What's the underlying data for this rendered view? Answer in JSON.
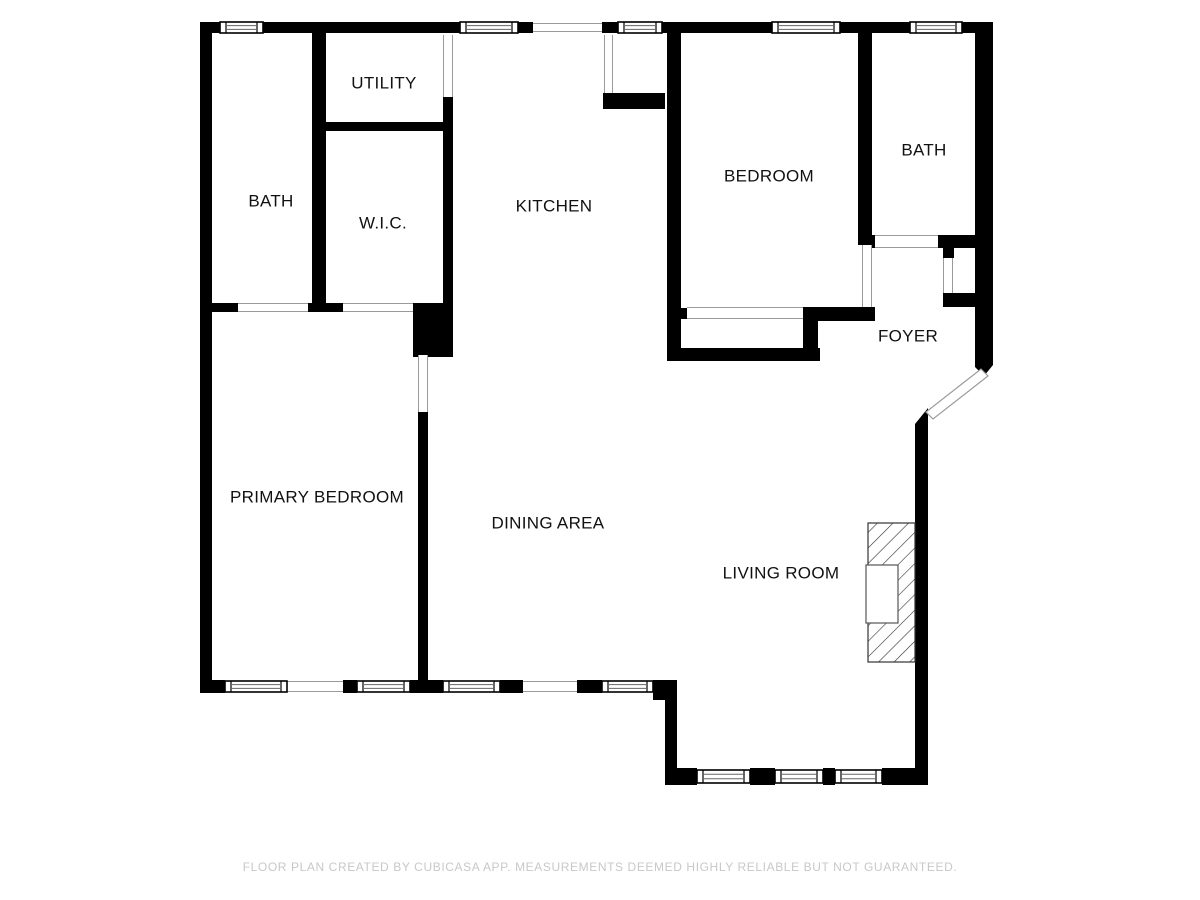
{
  "footer": {
    "text": "FLOOR PLAN CREATED BY CUBICASA APP. MEASUREMENTS DEEMED HIGHLY RELIABLE BUT NOT GUARANTEED."
  },
  "colors": {
    "background": "#ffffff",
    "wall": "#000000",
    "opening_line": "#9a9a9a",
    "window_frame": "#000000",
    "window_glass_line": "#666666",
    "label_text": "#111111",
    "caption_text": "#c8c8c8",
    "hatch": "#333333",
    "firebox_stroke": "#555555"
  },
  "rooms": [
    {
      "id": "utility",
      "label": "UTILITY",
      "x": 384,
      "y": 84
    },
    {
      "id": "bath-left",
      "label": "BATH",
      "x": 271,
      "y": 202
    },
    {
      "id": "wic",
      "label": "W.I.C.",
      "x": 383,
      "y": 224
    },
    {
      "id": "kitchen",
      "label": "KITCHEN",
      "x": 554,
      "y": 207
    },
    {
      "id": "bedroom",
      "label": "BEDROOM",
      "x": 769,
      "y": 177
    },
    {
      "id": "bath-right",
      "label": "BATH",
      "x": 924,
      "y": 151
    },
    {
      "id": "foyer",
      "label": "FOYER",
      "x": 908,
      "y": 337
    },
    {
      "id": "primary-bedroom",
      "label": "PRIMARY BEDROOM",
      "x": 317,
      "y": 498
    },
    {
      "id": "dining-area",
      "label": "DINING AREA",
      "x": 548,
      "y": 524
    },
    {
      "id": "living-room",
      "label": "LIVING ROOM",
      "x": 781,
      "y": 574
    }
  ],
  "plan": {
    "walls": [
      [
        200,
        22,
        20,
        11
      ],
      [
        263,
        22,
        197,
        11
      ],
      [
        518,
        22,
        15,
        11
      ],
      [
        602,
        22,
        16,
        11
      ],
      [
        662,
        22,
        110,
        11
      ],
      [
        840,
        22,
        70,
        11
      ],
      [
        962,
        22,
        31,
        11
      ],
      [
        200,
        33,
        12,
        660
      ],
      [
        200,
        680,
        25,
        13
      ],
      [
        343,
        680,
        14,
        13
      ],
      [
        410,
        680,
        33,
        13
      ],
      [
        500,
        680,
        23,
        13
      ],
      [
        577,
        680,
        25,
        13
      ],
      [
        653,
        680,
        24,
        20
      ],
      [
        665,
        680,
        12,
        100
      ],
      [
        665,
        768,
        32,
        17
      ],
      [
        750,
        768,
        25,
        17
      ],
      [
        823,
        768,
        12,
        17
      ],
      [
        882,
        768,
        45,
        17
      ],
      [
        915,
        424,
        13,
        361
      ],
      [
        975,
        33,
        18,
        325
      ],
      [
        312,
        33,
        14,
        270
      ],
      [
        326,
        122,
        117,
        9
      ],
      [
        443,
        97,
        10,
        206
      ],
      [
        212,
        303,
        26,
        9
      ],
      [
        308,
        303,
        35,
        9
      ],
      [
        413,
        303,
        40,
        54
      ],
      [
        418,
        412,
        10,
        268
      ],
      [
        603,
        93,
        62,
        16
      ],
      [
        667,
        33,
        14,
        328
      ],
      [
        667,
        348,
        153,
        13
      ],
      [
        803,
        310,
        15,
        43
      ],
      [
        677,
        308,
        10,
        11
      ],
      [
        803,
        307,
        72,
        14
      ],
      [
        858,
        33,
        14,
        212
      ],
      [
        866,
        235,
        9,
        13
      ],
      [
        938,
        235,
        55,
        13
      ],
      [
        943,
        246,
        11,
        12
      ],
      [
        943,
        293,
        50,
        14
      ]
    ],
    "wall_polys": [
      "915,424 928,424 928,408",
      "975,358 993,358 993,365 984,376 975,367"
    ],
    "entry_door_leaf": "981,369 988,376 933,419 926,412",
    "windows": [
      [
        220,
        22,
        43,
        11
      ],
      [
        460,
        22,
        58,
        11
      ],
      [
        618,
        22,
        44,
        11
      ],
      [
        772,
        22,
        68,
        11
      ],
      [
        910,
        22,
        52,
        11
      ],
      [
        225,
        681,
        62,
        11
      ],
      [
        357,
        681,
        53,
        11
      ],
      [
        443,
        681,
        57,
        11
      ],
      [
        602,
        681,
        51,
        11
      ],
      [
        697,
        770,
        53,
        13
      ],
      [
        775,
        770,
        48,
        13
      ],
      [
        835,
        770,
        47,
        13
      ]
    ],
    "openings": [
      [
        533,
        23,
        69,
        9,
        "h"
      ],
      [
        287,
        681,
        56,
        11,
        "h"
      ],
      [
        523,
        681,
        54,
        11,
        "h"
      ],
      [
        238,
        303,
        70,
        9,
        "h"
      ],
      [
        343,
        303,
        70,
        9,
        "h"
      ],
      [
        687,
        307,
        116,
        12,
        "h"
      ],
      [
        875,
        235,
        63,
        13,
        "h"
      ],
      [
        443,
        35,
        10,
        62,
        "v"
      ],
      [
        604,
        35,
        9,
        58,
        "v"
      ],
      [
        418,
        355,
        10,
        57,
        "v"
      ],
      [
        862,
        245,
        10,
        62,
        "v"
      ],
      [
        943,
        258,
        10,
        35,
        "v"
      ]
    ],
    "fireplace": {
      "hatch_rect": [
        868,
        523,
        47,
        139
      ],
      "firebox": [
        866,
        565,
        32,
        58
      ]
    }
  }
}
